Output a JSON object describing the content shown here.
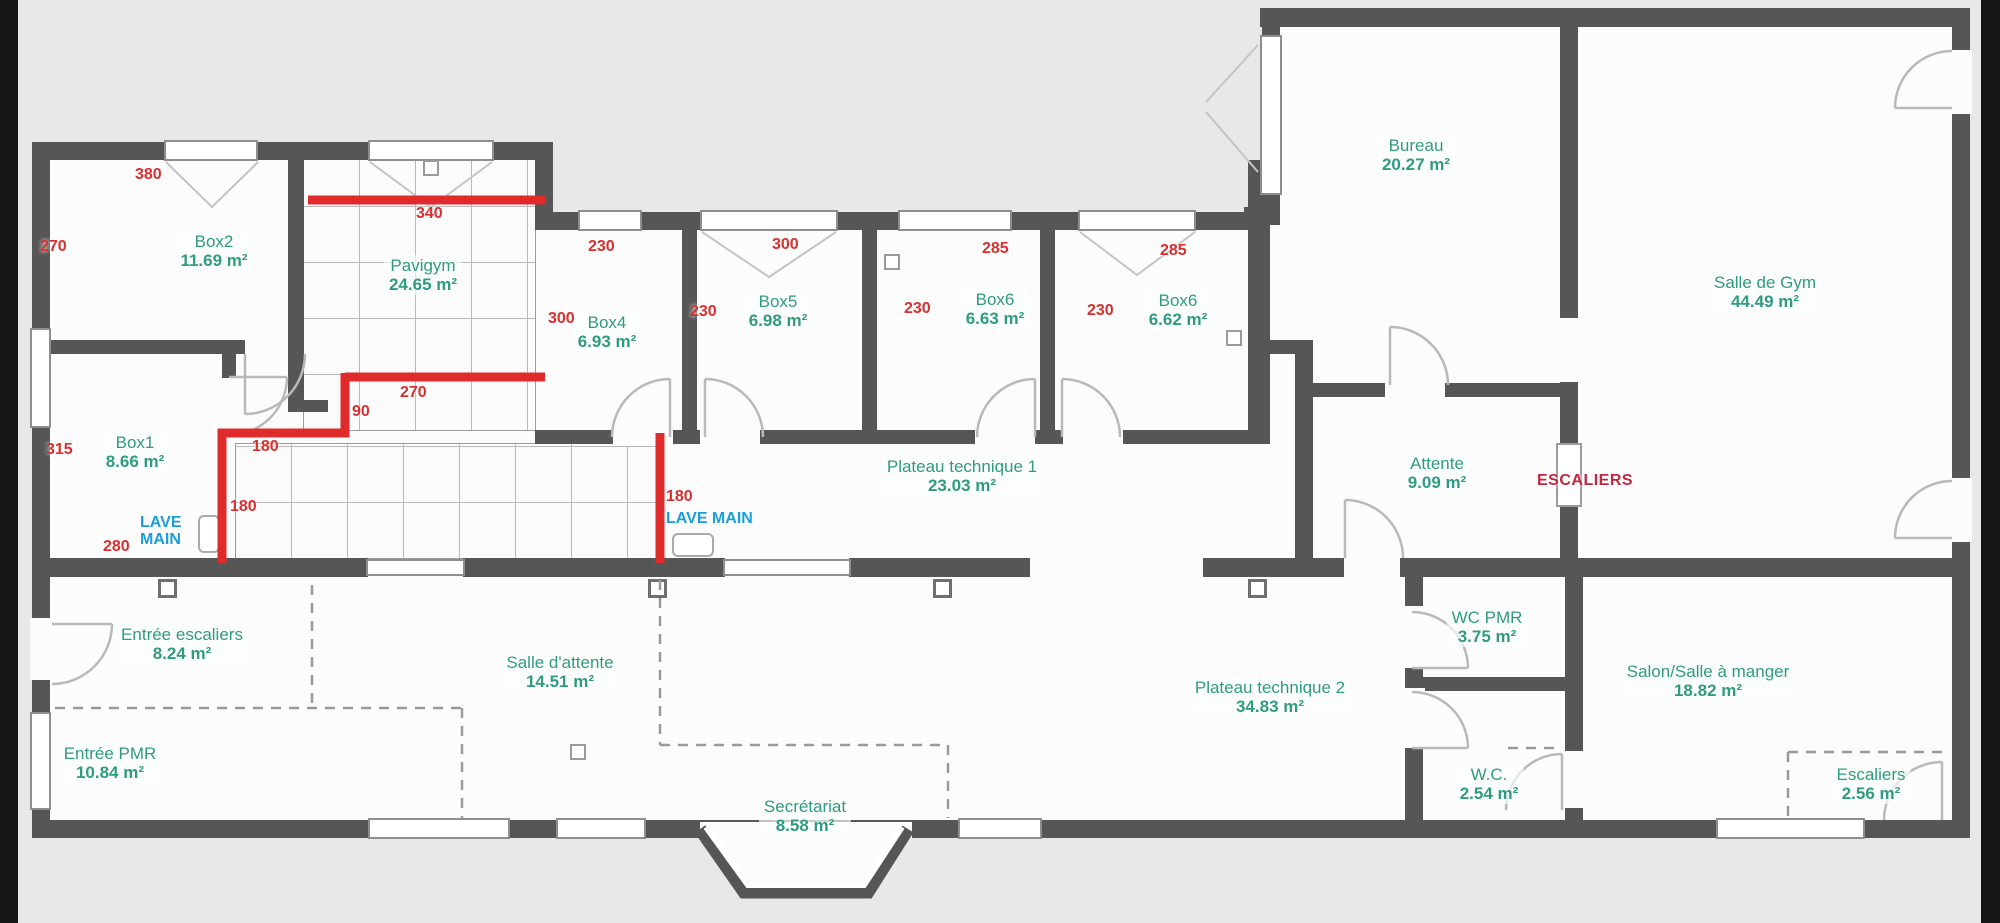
{
  "plan_title": "Floor plan",
  "colors": {
    "background": "#e8e8e8",
    "floor": "#fcfcfc",
    "wall": "#565656",
    "room_label_green": "#2f9b80",
    "dimension_red": "#d92f2f",
    "annotation_blue": "#1b9dd9",
    "escaliers_dark_red": "#c22740",
    "overlay_red_line": "#df2b2b"
  },
  "rooms": [
    {
      "name": "Box2",
      "area": "11.69 m²"
    },
    {
      "name": "Pavigym",
      "area": "24.65 m²"
    },
    {
      "name": "Box1",
      "area": "8.66 m²"
    },
    {
      "name": "Box4",
      "area": "6.93 m²"
    },
    {
      "name": "Box5",
      "area": "6.98 m²"
    },
    {
      "name": "Box6",
      "area": "6.63 m²"
    },
    {
      "name": "Box6",
      "area": "6.62 m²"
    },
    {
      "name": "Bureau",
      "area": "20.27 m²"
    },
    {
      "name": "Salle de Gym",
      "area": "44.49 m²"
    },
    {
      "name": "Plateau technique 1",
      "area": "23.03 m²"
    },
    {
      "name": "Attente",
      "area": "9.09 m²"
    },
    {
      "name": "Entrée escaliers",
      "area": "8.24 m²"
    },
    {
      "name": "Salle d'attente",
      "area": "14.51 m²"
    },
    {
      "name": "Entrée PMR",
      "area": "10.84 m²"
    },
    {
      "name": "Secrétariat",
      "area": "8.58 m²"
    },
    {
      "name": "Plateau technique 2",
      "area": "34.83 m²"
    },
    {
      "name": "WC PMR",
      "area": "3.75 m²"
    },
    {
      "name": "W.C.",
      "area": "2.54 m²"
    },
    {
      "name": "Salon/Salle à manger",
      "area": "18.82 m²"
    },
    {
      "name": "Escaliers",
      "area": "2.56 m²"
    }
  ],
  "dimensions": [
    "380",
    "270",
    "340",
    "315",
    "280",
    "180",
    "180",
    "90",
    "270",
    "300",
    "230",
    "230",
    "300",
    "230",
    "285",
    "230",
    "285",
    "180"
  ],
  "annotations": {
    "lave_main_1": "LAVE MAIN",
    "lave_main_2": "LAVE MAIN",
    "escaliers": "ESCALIERS"
  }
}
